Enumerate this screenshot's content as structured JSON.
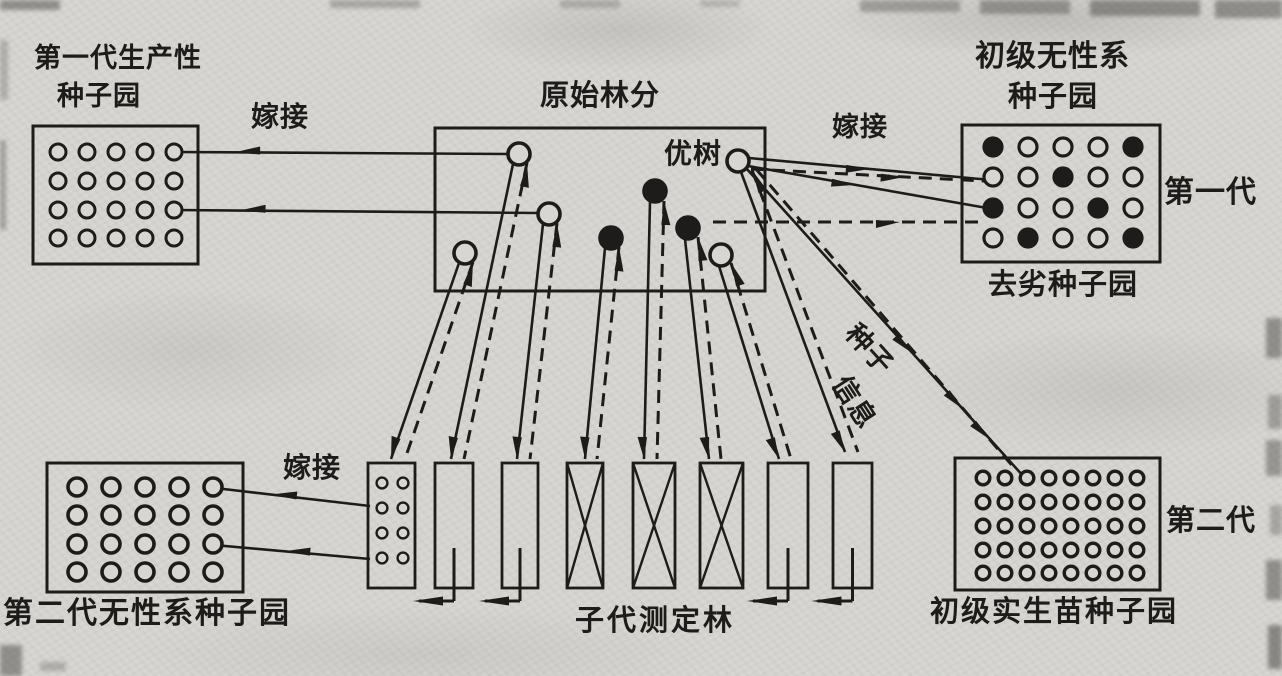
{
  "figure": {
    "background": "#d7d6d2",
    "ink": "#1d1c1a"
  },
  "labels": {
    "orchard1_title_line1": "第一代生产性",
    "orchard1_title_line2": "种子园",
    "graft_top_left": "嫁接",
    "original_stand": "原始林分",
    "plus_tree": "优树",
    "graft_top_right": "嫁接",
    "clonal_title_line1": "初级无性系",
    "clonal_title_line2": "种子园",
    "first_generation": "第一代",
    "roguing_orchard": "去劣种子园",
    "graft_bottom_left": "嫁接",
    "second_gen_clonal_orchard": "第二代无性系种子园",
    "progeny_test_forest": "子代测定林",
    "primary_seedling_orchard": "初级实生苗种子园",
    "second_generation": "第二代",
    "seed_flow": "种子",
    "info_flow": "信息"
  },
  "orchards": {
    "first_gen_productive": {
      "pattern": [
        "00000",
        "00000",
        "00000",
        "00000"
      ]
    },
    "primary_clonal": {
      "pattern": [
        "10001",
        "00100",
        "10010",
        "01001"
      ]
    },
    "second_gen_clonal": {
      "pattern": [
        "00000",
        "00000",
        "00000",
        "00000"
      ]
    },
    "primary_seedling": {
      "pattern": [
        "00000000",
        "00000000",
        "00000000",
        "00000000",
        "00000000"
      ]
    }
  },
  "original_stand_trees": [
    "open",
    "open",
    "open",
    "filled",
    "filled",
    "filled",
    "open",
    "open"
  ],
  "progeny_test": {
    "columns": [
      "seedling-plot",
      "selected",
      "selected",
      "rejected",
      "rejected",
      "rejected",
      "selected",
      "selected"
    ],
    "column1_pattern": [
      "00",
      "00",
      "00",
      "00"
    ]
  }
}
